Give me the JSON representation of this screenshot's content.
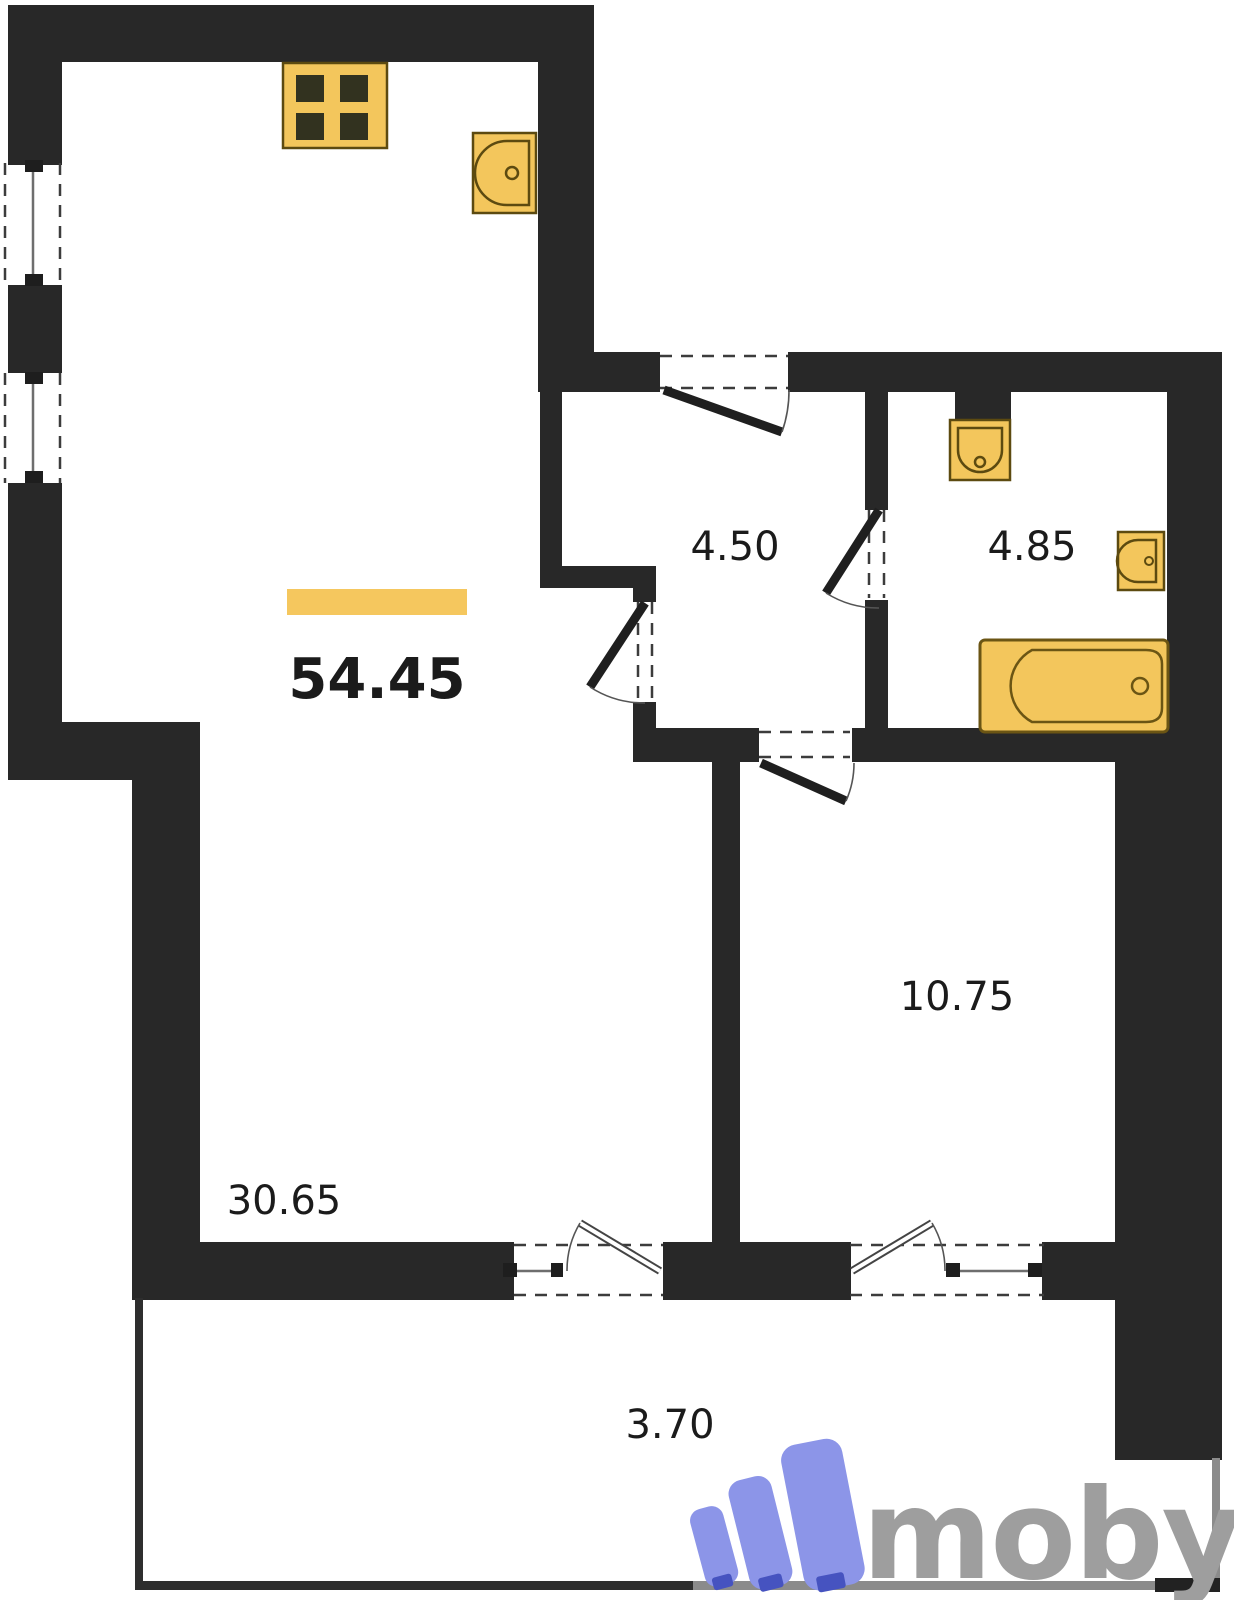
{
  "plan": {
    "total_area": "54.45",
    "rooms": {
      "hallway": {
        "area": "4.50"
      },
      "bathroom": {
        "area": "4.85"
      },
      "bedroom": {
        "area": "10.75"
      },
      "living": {
        "area": "30.65"
      },
      "balcony": {
        "area": "3.70"
      }
    },
    "fixtures": [
      "stove",
      "kitchen-sink",
      "toilet",
      "washbasin",
      "bathtub"
    ],
    "colors": {
      "wall": "#282828",
      "fixture_fill": "#F3C65C",
      "fixture_stroke": "#5c4a10",
      "highlight_bar": "#F5C75E",
      "label_text": "#1b1b1b",
      "balcony_rail_gray": "#8b8b8b"
    }
  },
  "watermark": {
    "brand": "moby",
    "icon_color": "#8C95E8",
    "icon_foot_color": "#4653C0",
    "text_color": "#9e9e9e"
  }
}
